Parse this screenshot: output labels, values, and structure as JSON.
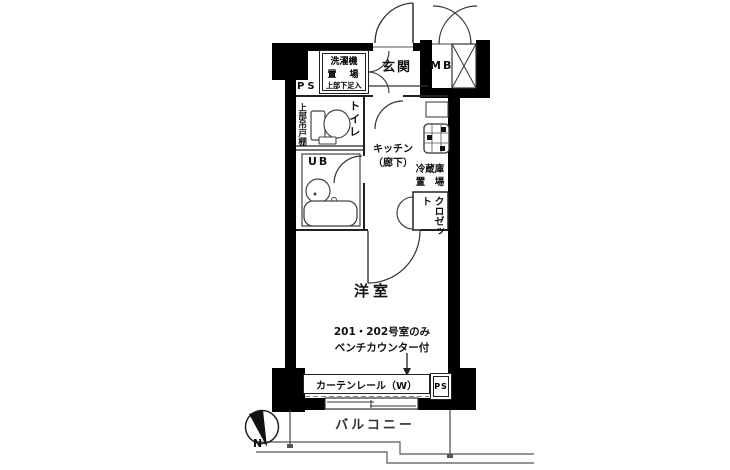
{
  "colors": {
    "wall": "#000000",
    "line": "#333333",
    "text": "#111111",
    "balcony_line": "#555555"
  },
  "labels": {
    "ps_top": "PS",
    "entrance": "玄関",
    "meter_box": "MB",
    "laundry_line1": "洗濯機",
    "laundry_line2": "置　場",
    "laundry_line3": "上部下足入",
    "upper_cabinet": "上部吊戸棚",
    "toilet": "トイレ",
    "unit_bath": "UB",
    "kitchen_line1": "キッチン",
    "kitchen_line2": "（廊下）",
    "fridge_line1": "冷蔵庫",
    "fridge_line2": "置　場",
    "closet": "クロゼット",
    "western_room": "洋室",
    "note_line1": "201・202号室のみ",
    "note_line2": "ベンチカウンター付",
    "curtain_rail": "カーテンレール（W）",
    "ps_bottom": "PS",
    "balcony": "バルコニー",
    "compass_north": "N"
  }
}
